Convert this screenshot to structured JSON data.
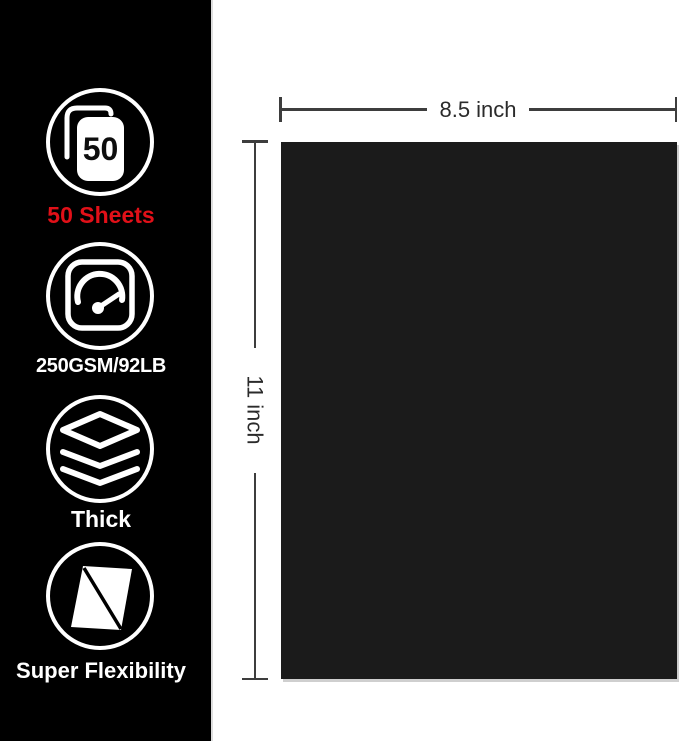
{
  "sidebar": {
    "features": [
      {
        "icon": "sheet-stack-icon",
        "badge": "50",
        "label": "50 Sheets",
        "label_color": "#e11018"
      },
      {
        "icon": "gauge-icon",
        "label": "250GSM/92LB",
        "label_color": "#ffffff"
      },
      {
        "icon": "layers-icon",
        "label": "Thick",
        "label_color": "#ffffff"
      },
      {
        "icon": "flexible-sheet-icon",
        "label": "Super Flexibility",
        "label_color": "#ffffff"
      }
    ]
  },
  "diagram": {
    "width_label": "8.5 inch",
    "height_label": "11 inch"
  },
  "colors": {
    "sidebar_bg": "#000000",
    "paper": "#1b1b1b",
    "accent_red": "#e11018",
    "dimension_line": "#3d3d3d",
    "dimension_text": "#2b2b2b",
    "icon_stroke": "#ffffff"
  }
}
